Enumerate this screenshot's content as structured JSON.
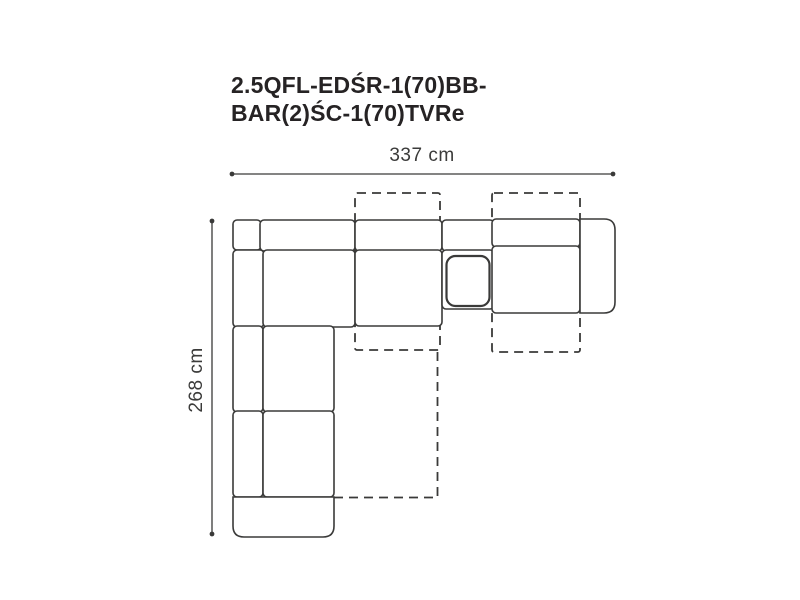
{
  "title": {
    "line1": "2.5QFL-EDŚR-1(70)BB-",
    "line2": "BAR(2)ŚC-1(70)TVRe"
  },
  "dimensions": {
    "width_label": "337 cm",
    "height_label": "268 cm"
  },
  "colors": {
    "background": "#ffffff",
    "line": "#3a3a39",
    "title_text": "#262324",
    "dimension_text": "#3b3b3a"
  }
}
